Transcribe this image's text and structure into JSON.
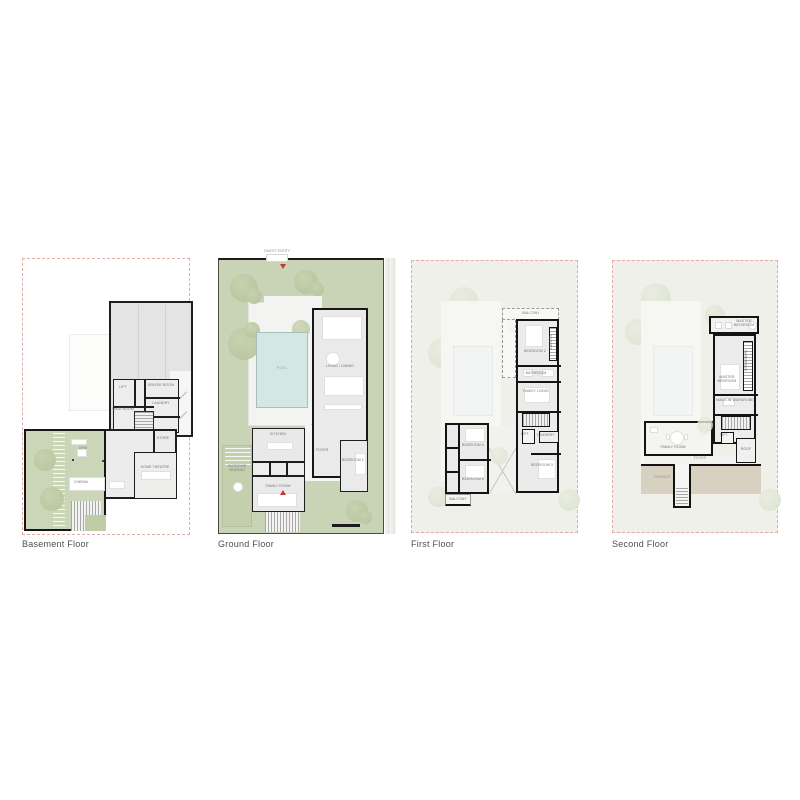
{
  "colors": {
    "canvas_bg": "#ffffff",
    "boundary_dashed_pink": "#e7a8a8",
    "wall_dark": "#1e1e1e",
    "lawn_green": "#c9d3b6",
    "tree_green": "#b9c7a1",
    "pool_blue": "#d5e7e5",
    "interior_gray": "#eaeaea",
    "garage_gray": "#e4e4e4",
    "faded_floor_bg": "#eef0e9",
    "terrace_tan": "#d8d1c2",
    "entry_marker_red": "#c23b2e",
    "caption_text": "#4f4f4f"
  },
  "panels": [
    {
      "caption": "Basement Floor",
      "labels": {
        "lift": "LIFT",
        "driver_room": "DRIVER ROOM",
        "laundry": "LAUNDRY",
        "maid_room": "MAID ROOM",
        "store": "STORE",
        "gym": "GYM",
        "cinema": "CINEMA",
        "home_theatre": "HOME THEATRE"
      }
    },
    {
      "caption": "Ground Floor",
      "labels": {
        "guest_entry": "GUEST ENTRY",
        "pool": "POOL",
        "living_dining": "LIVING / DINING",
        "kitchen": "KITCHEN",
        "foyer": "FOYER",
        "family_room": "FAMILY ROOM",
        "bedroom_1": "BEDROOM 1",
        "outdoor_seating": "OUTDOOR SEATING"
      }
    },
    {
      "caption": "First Floor",
      "labels": {
        "balcony": "BALCONY",
        "bedroom_2": "BEDROOM 2",
        "closet": "CLOSET",
        "bathroom": "BATHROOM",
        "family_living": "FAMILY LIVING",
        "lift": "LIFT",
        "laundry": "LAUNDRY",
        "bedroom_3": "BEDROOM 3",
        "bedroom_4": "BEDROOM 4",
        "bedroom_5": "BEDROOM 5",
        "balcony_2": "BALCONY"
      }
    },
    {
      "caption": "Second Floor",
      "labels": {
        "master_bathroom": "MASTER BATHROOM",
        "master_bedroom": "MASTER BEDROOM",
        "wardrobe": "WARDROBE",
        "walkin_wardrobe": "WALK-IN WARDROBE",
        "lift": "LIFT",
        "roof": "ROOF",
        "family_room": "FAMILY ROOM",
        "foyer": "FOYER",
        "terrace": "TERRACE"
      }
    }
  ]
}
